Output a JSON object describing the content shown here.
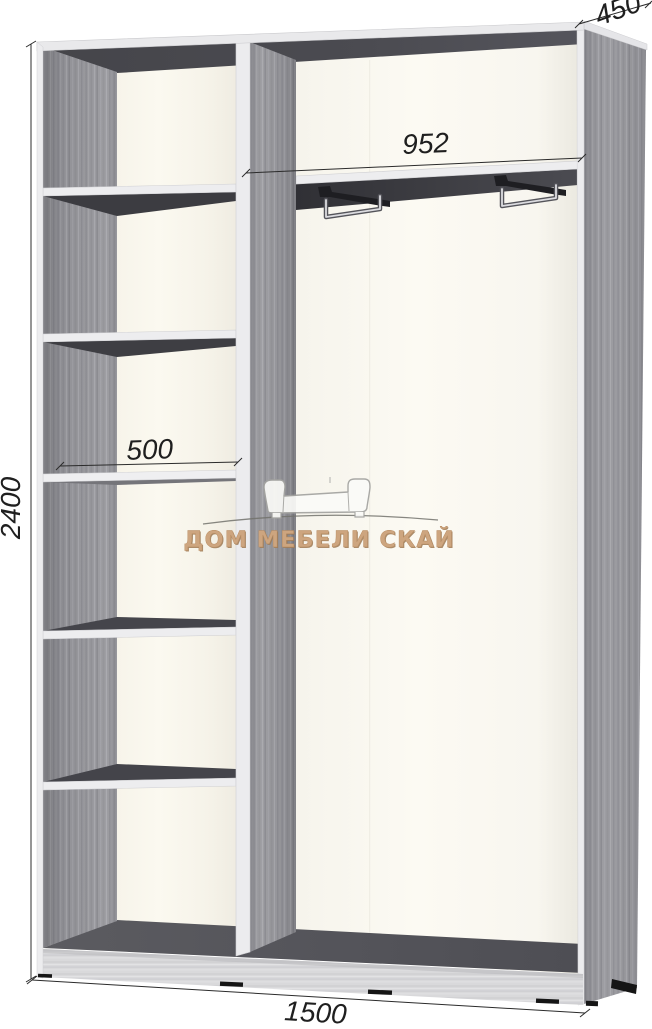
{
  "diagram": {
    "kind": "wardrobe-interior-technical-drawing",
    "dims": {
      "height": "2400",
      "total_width": "1500",
      "depth": "450",
      "right_section_width": "952",
      "left_section_width": "500"
    },
    "watermark": {
      "text": "ДОМ МЕБЕЛИ СКАЙ",
      "icon": "sofa-outline-icon"
    },
    "features": {
      "left_shelf_count": 5,
      "hanger_rail_count": 2
    },
    "colors": {
      "carcass_gray": "#97979c",
      "interior_shadow": "#46464c",
      "back_panel_cream": "#f8f5ec",
      "plinth_gray": "#d9d9db",
      "dimension_text": "#1f1f1f",
      "watermark_tan": "#cda57f"
    }
  }
}
